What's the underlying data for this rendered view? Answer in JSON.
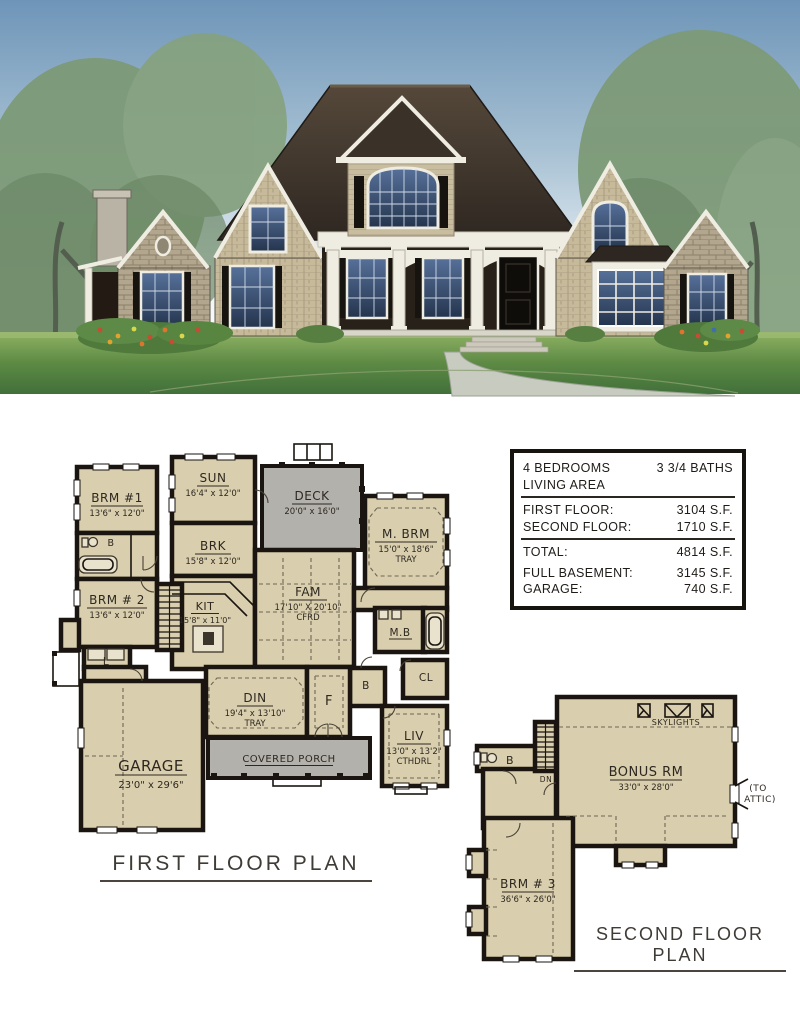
{
  "colors": {
    "plan_fill": "#d9cfae",
    "plan_wall": "#1a1511",
    "deck_fill": "#b3b1ac",
    "plan_text": "#2e2820",
    "sky_top": "#6e95b8",
    "lawn_dark": "#41703a",
    "lawn_light": "#8fb264",
    "roof_dark": "#2e2721",
    "roof_light": "#55483a",
    "siding": "#c9bda0",
    "stone": "#b3a68e",
    "trim": "#efece2",
    "shutter": "#17130e",
    "glass_dark": "#24344d",
    "glass_light": "#57719a"
  },
  "spec_table": {
    "bedrooms": "4 BEDROOMS",
    "baths": "3 3/4 BATHS",
    "living_area": "LIVING AREA",
    "rows": [
      {
        "label": "FIRST FLOOR:",
        "value": "3104 S.F."
      },
      {
        "label": "SECOND FLOOR:",
        "value": "1710 S.F."
      },
      {
        "label": "TOTAL:",
        "value": "4814 S.F."
      },
      {
        "label": "FULL BASEMENT:",
        "value": "3145 S.F."
      },
      {
        "label": "GARAGE:",
        "value": "740 S.F."
      }
    ]
  },
  "first_floor": {
    "title": "FIRST FLOOR PLAN",
    "rooms": {
      "brm1": {
        "name": "BRM #1",
        "dims": "13'6\" x 12'0\""
      },
      "brm2": {
        "name": "BRM # 2",
        "dims": "13'6\" x 12'0\""
      },
      "sun": {
        "name": "SUN",
        "dims": "16'4\" x 12'0\""
      },
      "brk": {
        "name": "BRK",
        "dims": "15'8\" x 12'0\""
      },
      "kit": {
        "name": "KIT",
        "dims": "15'8\" x 11'0\""
      },
      "deck": {
        "name": "DECK",
        "dims": "20'0\" x 16'0\""
      },
      "fam": {
        "name": "FAM",
        "dims": "17'10\" X 20'10\"",
        "note": "CFRD"
      },
      "mbrm": {
        "name": "M. BRM",
        "dims": "15'0\" x 18'6\"",
        "note": "TRAY"
      },
      "mbath": {
        "name": "M.B"
      },
      "din": {
        "name": "DIN",
        "dims": "19'4\" x 13'10\"",
        "note": "TRAY"
      },
      "foyer": {
        "name": "F"
      },
      "bath": {
        "name": "B"
      },
      "halfbath": {
        "name": "B"
      },
      "closet": {
        "name": "CL"
      },
      "laundry": {
        "name": "L"
      },
      "liv": {
        "name": "LIV",
        "dims": "13'0\" x 13'2\"",
        "note": "CTHDRL"
      },
      "garage": {
        "name": "GARAGE",
        "dims": "23'0\" x 29'6\""
      },
      "porch": {
        "name": "COVERED PORCH"
      }
    }
  },
  "second_floor": {
    "title": "SECOND FLOOR PLAN",
    "rooms": {
      "bonus": {
        "name": "BONUS RM",
        "dims": "33'0\" x 28'0\""
      },
      "brm3": {
        "name": "BRM # 3",
        "dims": "36'6\" x 26'0\""
      },
      "bath": {
        "name": "B"
      }
    },
    "labels": {
      "skylights": "SKYLIGHTS",
      "dn": "DN",
      "to_attic": [
        "(TO",
        "ATTIC)"
      ]
    }
  }
}
